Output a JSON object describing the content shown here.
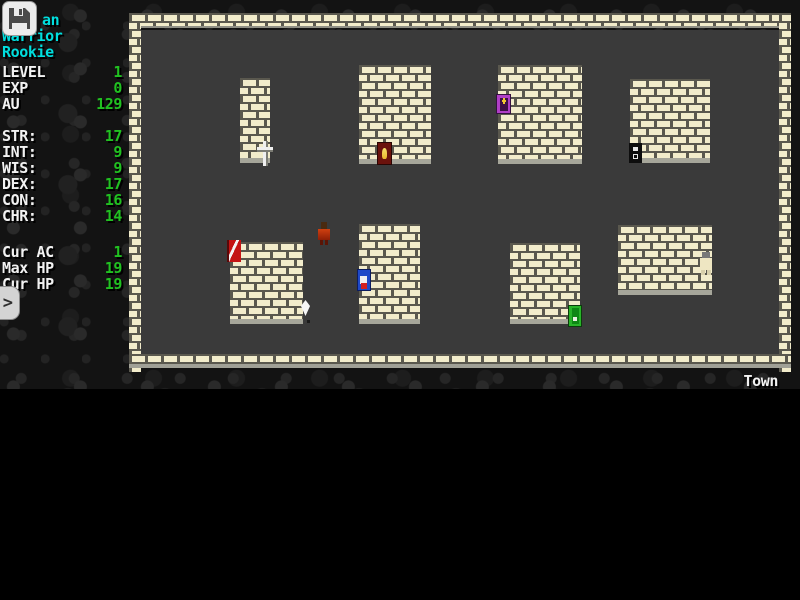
{
  "sidebar": {
    "character": {
      "name_fragment": "an",
      "class": "Warrior",
      "rank": "Rookie"
    },
    "progress": [
      {
        "label": "LEVEL",
        "value": "1"
      },
      {
        "label": "EXP",
        "value": "0"
      },
      {
        "label": "AU",
        "value": "129"
      }
    ],
    "attributes": [
      {
        "label": "STR:",
        "value": "17"
      },
      {
        "label": "INT:",
        "value": "9"
      },
      {
        "label": "WIS:",
        "value": "9"
      },
      {
        "label": "DEX:",
        "value": "17"
      },
      {
        "label": "CON:",
        "value": "16"
      },
      {
        "label": "CHR:",
        "value": "14"
      }
    ],
    "vitals": [
      {
        "label": "Cur AC",
        "value": "1"
      },
      {
        "label": "Max HP",
        "value": "19"
      },
      {
        "label": "Cur HP",
        "value": "19"
      }
    ],
    "prompt_symbol": ">"
  },
  "map": {
    "location_label": "Town"
  },
  "colors": {
    "text_white": "#f2f2f2",
    "text_cyan": "#00dede",
    "text_green": "#21c121",
    "brick": "#f2eccb",
    "mortar": "#5a584e",
    "floor": "#3a3a3a",
    "background": "#131313"
  }
}
